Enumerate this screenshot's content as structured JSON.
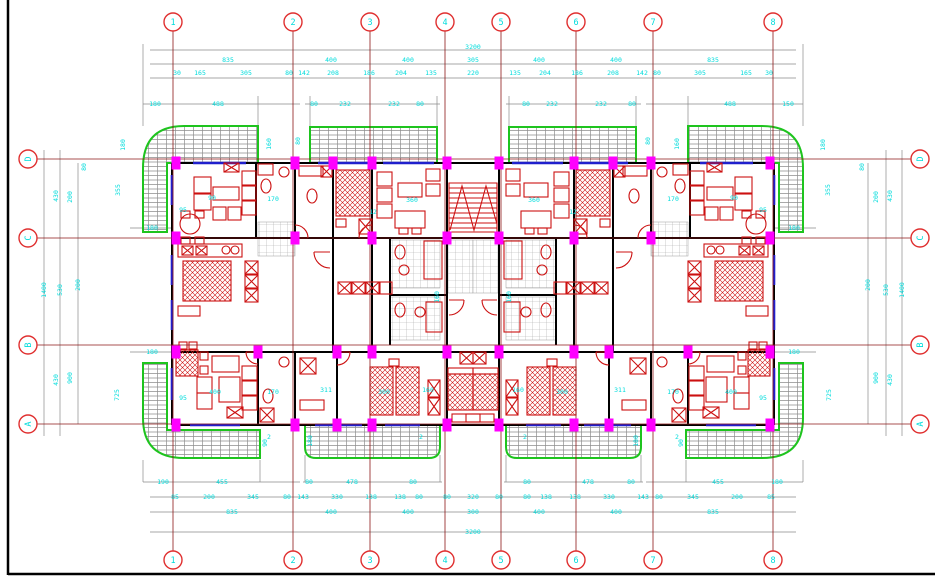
{
  "drawing": {
    "type": "architectural-floor-plan",
    "colors": {
      "background": "#ffffff",
      "grid_line": "#8c1616",
      "bubble_stroke": "#e03030",
      "dim_text": "#00dcdc",
      "dim_line": "#8a8a8a",
      "wall": "#000000",
      "window": "#2020cc",
      "column": "#ff00ff",
      "balcony": "#1ec41e",
      "furniture": "#cc1111",
      "frame": "#000000"
    },
    "grid": {
      "top_bubbles": [
        "1",
        "2",
        "3",
        "4",
        "5",
        "6",
        "7",
        "8"
      ],
      "bottom_bubbles": [
        "1",
        "2",
        "3",
        "4",
        "5",
        "6",
        "7",
        "8"
      ],
      "left_bubbles": [
        "D",
        "C",
        "B",
        "A"
      ],
      "right_bubbles": [
        "D",
        "C",
        "B",
        "A"
      ]
    },
    "dims": {
      "top": [
        {
          "t": "3200",
          "x": 473,
          "y": 47
        },
        {
          "t": "835",
          "x": 228,
          "y": 60
        },
        {
          "t": "400",
          "x": 331,
          "y": 60
        },
        {
          "t": "400",
          "x": 408,
          "y": 60
        },
        {
          "t": "305",
          "x": 473,
          "y": 60
        },
        {
          "t": "400",
          "x": 539,
          "y": 60
        },
        {
          "t": "400",
          "x": 616,
          "y": 60
        },
        {
          "t": "835",
          "x": 713,
          "y": 60
        },
        {
          "t": "30",
          "x": 177,
          "y": 73
        },
        {
          "t": "165",
          "x": 200,
          "y": 73
        },
        {
          "t": "305",
          "x": 246,
          "y": 73
        },
        {
          "t": "80",
          "x": 289,
          "y": 73
        },
        {
          "t": "142",
          "x": 304,
          "y": 73
        },
        {
          "t": "208",
          "x": 333,
          "y": 73
        },
        {
          "t": "186",
          "x": 369,
          "y": 73
        },
        {
          "t": "204",
          "x": 401,
          "y": 73
        },
        {
          "t": "135",
          "x": 431,
          "y": 73
        },
        {
          "t": "220",
          "x": 473,
          "y": 73
        },
        {
          "t": "135",
          "x": 515,
          "y": 73
        },
        {
          "t": "204",
          "x": 545,
          "y": 73
        },
        {
          "t": "186",
          "x": 577,
          "y": 73
        },
        {
          "t": "208",
          "x": 613,
          "y": 73
        },
        {
          "t": "142",
          "x": 642,
          "y": 73
        },
        {
          "t": "80",
          "x": 657,
          "y": 73
        },
        {
          "t": "305",
          "x": 700,
          "y": 73
        },
        {
          "t": "165",
          "x": 746,
          "y": 73
        },
        {
          "t": "30",
          "x": 769,
          "y": 73
        },
        {
          "t": "180",
          "x": 155,
          "y": 104
        },
        {
          "t": "488",
          "x": 218,
          "y": 104
        },
        {
          "t": "80",
          "x": 314,
          "y": 104
        },
        {
          "t": "232",
          "x": 345,
          "y": 104
        },
        {
          "t": "232",
          "x": 394,
          "y": 104
        },
        {
          "t": "80",
          "x": 420,
          "y": 104
        },
        {
          "t": "80",
          "x": 526,
          "y": 104
        },
        {
          "t": "232",
          "x": 552,
          "y": 104
        },
        {
          "t": "232",
          "x": 601,
          "y": 104
        },
        {
          "t": "80",
          "x": 632,
          "y": 104
        },
        {
          "t": "488",
          "x": 730,
          "y": 104
        },
        {
          "t": "150",
          "x": 788,
          "y": 104
        },
        {
          "t": "180",
          "x": 123,
          "y": 145,
          "r": 1
        },
        {
          "t": "160",
          "x": 269,
          "y": 144,
          "r": 1
        },
        {
          "t": "80",
          "x": 298,
          "y": 141,
          "r": 1
        },
        {
          "t": "80",
          "x": 648,
          "y": 141,
          "r": 1
        },
        {
          "t": "160",
          "x": 677,
          "y": 144,
          "r": 1
        },
        {
          "t": "180",
          "x": 823,
          "y": 145,
          "r": 1
        }
      ],
      "bottom": [
        {
          "t": "190",
          "x": 163,
          "y": 482
        },
        {
          "t": "455",
          "x": 222,
          "y": 482
        },
        {
          "t": "80",
          "x": 309,
          "y": 482
        },
        {
          "t": "478",
          "x": 352,
          "y": 482
        },
        {
          "t": "80",
          "x": 413,
          "y": 482
        },
        {
          "t": "80",
          "x": 527,
          "y": 482
        },
        {
          "t": "478",
          "x": 588,
          "y": 482
        },
        {
          "t": "80",
          "x": 631,
          "y": 482
        },
        {
          "t": "455",
          "x": 718,
          "y": 482
        },
        {
          "t": "180",
          "x": 777,
          "y": 482
        },
        {
          "t": "85",
          "x": 175,
          "y": 497
        },
        {
          "t": "200",
          "x": 209,
          "y": 497
        },
        {
          "t": "345",
          "x": 253,
          "y": 497
        },
        {
          "t": "80",
          "x": 287,
          "y": 497
        },
        {
          "t": "143",
          "x": 303,
          "y": 497
        },
        {
          "t": "330",
          "x": 337,
          "y": 497
        },
        {
          "t": "138",
          "x": 371,
          "y": 497
        },
        {
          "t": "138",
          "x": 400,
          "y": 497
        },
        {
          "t": "80",
          "x": 419,
          "y": 497
        },
        {
          "t": "80",
          "x": 447,
          "y": 497
        },
        {
          "t": "320",
          "x": 473,
          "y": 497
        },
        {
          "t": "80",
          "x": 499,
          "y": 497
        },
        {
          "t": "80",
          "x": 527,
          "y": 497
        },
        {
          "t": "138",
          "x": 546,
          "y": 497
        },
        {
          "t": "138",
          "x": 575,
          "y": 497
        },
        {
          "t": "330",
          "x": 609,
          "y": 497
        },
        {
          "t": "143",
          "x": 643,
          "y": 497
        },
        {
          "t": "80",
          "x": 659,
          "y": 497
        },
        {
          "t": "345",
          "x": 693,
          "y": 497
        },
        {
          "t": "200",
          "x": 737,
          "y": 497
        },
        {
          "t": "85",
          "x": 771,
          "y": 497
        },
        {
          "t": "835",
          "x": 232,
          "y": 512
        },
        {
          "t": "400",
          "x": 331,
          "y": 512
        },
        {
          "t": "400",
          "x": 408,
          "y": 512
        },
        {
          "t": "300",
          "x": 473,
          "y": 512
        },
        {
          "t": "400",
          "x": 539,
          "y": 512
        },
        {
          "t": "400",
          "x": 616,
          "y": 512
        },
        {
          "t": "835",
          "x": 713,
          "y": 512
        },
        {
          "t": "3200",
          "x": 473,
          "y": 532
        },
        {
          "t": "90",
          "x": 265,
          "y": 443,
          "r": 1
        },
        {
          "t": "180",
          "x": 310,
          "y": 441,
          "r": 1
        },
        {
          "t": "180",
          "x": 636,
          "y": 441,
          "r": 1
        },
        {
          "t": "90",
          "x": 681,
          "y": 443,
          "r": 1
        },
        {
          "t": "2",
          "x": 269,
          "y": 437
        },
        {
          "t": "2",
          "x": 421,
          "y": 437
        },
        {
          "t": "2",
          "x": 525,
          "y": 437
        },
        {
          "t": "2",
          "x": 677,
          "y": 437
        }
      ],
      "left": [
        {
          "t": "430",
          "x": 56,
          "y": 196,
          "r": 1
        },
        {
          "t": "200",
          "x": 70,
          "y": 197,
          "r": 1
        },
        {
          "t": "80",
          "x": 84,
          "y": 167,
          "r": 1
        },
        {
          "t": "355",
          "x": 118,
          "y": 190,
          "r": 1
        },
        {
          "t": "1400",
          "x": 44,
          "y": 290,
          "r": 1
        },
        {
          "t": "530",
          "x": 60,
          "y": 290,
          "r": 1
        },
        {
          "t": "200",
          "x": 78,
          "y": 285,
          "r": 1
        },
        {
          "t": "430",
          "x": 56,
          "y": 380,
          "r": 1
        },
        {
          "t": "900",
          "x": 70,
          "y": 378,
          "r": 1
        },
        {
          "t": "725",
          "x": 117,
          "y": 395,
          "r": 1
        },
        {
          "t": "180",
          "x": 152,
          "y": 228
        },
        {
          "t": "180",
          "x": 152,
          "y": 352
        }
      ],
      "right": [
        {
          "t": "430",
          "x": 890,
          "y": 196,
          "r": 1
        },
        {
          "t": "200",
          "x": 876,
          "y": 197,
          "r": 1
        },
        {
          "t": "80",
          "x": 862,
          "y": 167,
          "r": 1
        },
        {
          "t": "355",
          "x": 828,
          "y": 190,
          "r": 1
        },
        {
          "t": "1400",
          "x": 902,
          "y": 290,
          "r": 1
        },
        {
          "t": "530",
          "x": 886,
          "y": 290,
          "r": 1
        },
        {
          "t": "200",
          "x": 868,
          "y": 285,
          "r": 1
        },
        {
          "t": "430",
          "x": 890,
          "y": 380,
          "r": 1
        },
        {
          "t": "900",
          "x": 876,
          "y": 378,
          "r": 1
        },
        {
          "t": "725",
          "x": 829,
          "y": 395,
          "r": 1
        },
        {
          "t": "180",
          "x": 794,
          "y": 228
        },
        {
          "t": "180",
          "x": 794,
          "y": 352
        }
      ],
      "interior": [
        {
          "t": "90",
          "x": 212,
          "y": 198
        },
        {
          "t": "170",
          "x": 273,
          "y": 199
        },
        {
          "t": "95",
          "x": 183,
          "y": 210
        },
        {
          "t": "360",
          "x": 412,
          "y": 200
        },
        {
          "t": "360",
          "x": 534,
          "y": 200
        },
        {
          "t": "170",
          "x": 673,
          "y": 199
        },
        {
          "t": "90",
          "x": 734,
          "y": 198
        },
        {
          "t": "95",
          "x": 763,
          "y": 210
        },
        {
          "t": "12",
          "x": 373,
          "y": 212
        },
        {
          "t": "12",
          "x": 573,
          "y": 212
        },
        {
          "t": "400",
          "x": 215,
          "y": 392
        },
        {
          "t": "95",
          "x": 183,
          "y": 398
        },
        {
          "t": "170",
          "x": 273,
          "y": 392
        },
        {
          "t": "311",
          "x": 326,
          "y": 390
        },
        {
          "t": "300",
          "x": 384,
          "y": 392
        },
        {
          "t": "160",
          "x": 428,
          "y": 390
        },
        {
          "t": "160",
          "x": 518,
          "y": 390
        },
        {
          "t": "300",
          "x": 562,
          "y": 392
        },
        {
          "t": "311",
          "x": 620,
          "y": 390
        },
        {
          "t": "170",
          "x": 673,
          "y": 392
        },
        {
          "t": "400",
          "x": 731,
          "y": 392
        },
        {
          "t": "95",
          "x": 763,
          "y": 398
        },
        {
          "t": "160",
          "x": 437,
          "y": 297,
          "r": 1
        },
        {
          "t": "160",
          "x": 509,
          "y": 297,
          "r": 1
        }
      ]
    }
  }
}
